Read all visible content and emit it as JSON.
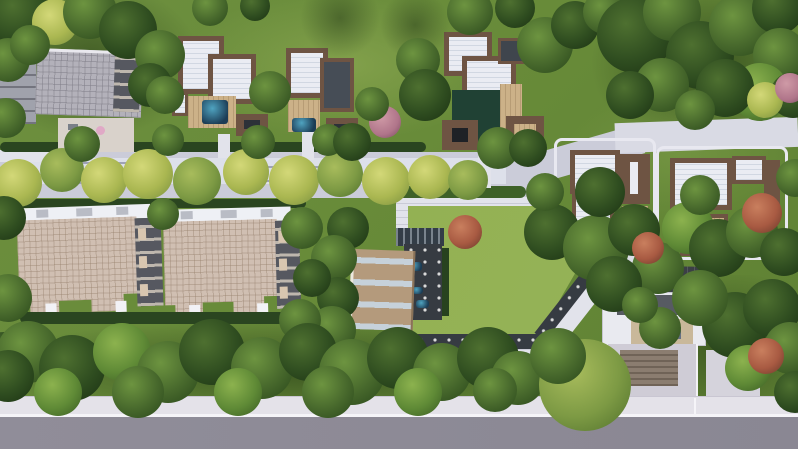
{
  "scene": {
    "description": "Aerial top-down 3D architectural rendering of a gated residential development: flat-roofed villas with brown trim in the upper and right areas, two large apartment blocks with beige panel roofs at lower left, a central lawn bordered by stepped white paths and dark bollard-lit paving, a pool clubhouse with skylight roof, tree-lined internal walkways, an entrance gatehouse at lower right, dense perimeter trees and a grey asphalt road along the bottom edge",
    "features": {
      "villas_top_row": 3,
      "villas_right_side": 2,
      "apartment_blocks": 2,
      "clubhouse_with_pool_deck": 1,
      "entrance_gatehouse": 1,
      "central_lawn": 1,
      "tree_lined_walkways": 2,
      "perimeter_road_bottom": 1
    },
    "palette": {
      "grass_base": "#6d8f3f",
      "grass_light": "#93b153",
      "grass_dark": "#4e6e2f",
      "lawn": "#95b257",
      "walk": "#cbccd9",
      "walk_light": "#e2e3eb",
      "road_asphalt": "#8a8793",
      "sidewalk": "#e4e2e9",
      "white_line": "#f5f4f8",
      "roof_white": "#eaecf3",
      "roof_trim": "#6e5443",
      "roof_grey": "#b3b1ba",
      "facade_dark": "#565860",
      "apt_roof": "#d0bfb2",
      "deck_tan": "#ccb188",
      "pool_blue": "#1c3c55",
      "pool_cyan": "#4fa3c0",
      "dark_paving": "#363b42",
      "hedge": "#2a4520",
      "club_roof": "#b49a7c",
      "glass": "#c2cfdb",
      "tree_dark": "#2f4d20",
      "tree_mid": "#47682c",
      "tree_bright": "#5f8a36",
      "tree_yellow": "#aab751",
      "tree_olive": "#7d9a44",
      "tree_red": "#a85a42",
      "tree_pink": "#b0758a"
    },
    "trees": [
      {
        "x": 20,
        "y": 15,
        "d": 64,
        "t": "dark"
      },
      {
        "x": 55,
        "y": 22,
        "d": 46,
        "t": "yellow"
      },
      {
        "x": 90,
        "y": 12,
        "d": 54,
        "t": "mid"
      },
      {
        "x": 128,
        "y": 30,
        "d": 58,
        "t": "dark"
      },
      {
        "x": 160,
        "y": 55,
        "d": 50,
        "t": "mid"
      },
      {
        "x": 8,
        "y": 60,
        "d": 44,
        "t": "mid"
      },
      {
        "x": 30,
        "y": 45,
        "d": 40,
        "t": "mid"
      },
      {
        "x": 150,
        "y": 85,
        "d": 44,
        "t": "dark"
      },
      {
        "x": 210,
        "y": 8,
        "d": 36,
        "t": "mid"
      },
      {
        "x": 255,
        "y": 6,
        "d": 30,
        "t": "dark"
      },
      {
        "x": 340,
        "y": 18,
        "d": 80,
        "t": "shadow"
      },
      {
        "x": 415,
        "y": 25,
        "d": 70,
        "t": "shadow"
      },
      {
        "x": 418,
        "y": 60,
        "d": 44,
        "t": "mid"
      },
      {
        "x": 425,
        "y": 95,
        "d": 52,
        "t": "dark"
      },
      {
        "x": 470,
        "y": 12,
        "d": 46,
        "t": "mid"
      },
      {
        "x": 515,
        "y": 8,
        "d": 40,
        "t": "dark"
      },
      {
        "x": 545,
        "y": 45,
        "d": 56,
        "t": "mid"
      },
      {
        "x": 575,
        "y": 25,
        "d": 48,
        "t": "dark"
      },
      {
        "x": 605,
        "y": 12,
        "d": 44,
        "t": "mid"
      },
      {
        "x": 635,
        "y": 35,
        "d": 76,
        "t": "dark"
      },
      {
        "x": 672,
        "y": 12,
        "d": 58,
        "t": "mid"
      },
      {
        "x": 700,
        "y": 55,
        "d": 68,
        "t": "dark"
      },
      {
        "x": 740,
        "y": 25,
        "d": 62,
        "t": "mid"
      },
      {
        "x": 778,
        "y": 8,
        "d": 52,
        "t": "dark"
      },
      {
        "x": 780,
        "y": 55,
        "d": 54,
        "t": "mid"
      },
      {
        "x": 760,
        "y": 92,
        "d": 58,
        "t": "bright"
      },
      {
        "x": 793,
        "y": 95,
        "d": 46,
        "t": "dark"
      },
      {
        "x": 725,
        "y": 88,
        "d": 58,
        "t": "dark"
      },
      {
        "x": 662,
        "y": 85,
        "d": 54,
        "t": "mid"
      },
      {
        "x": 630,
        "y": 95,
        "d": 48,
        "t": "dark"
      },
      {
        "x": 695,
        "y": 110,
        "d": 40,
        "t": "mid"
      },
      {
        "x": 765,
        "y": 100,
        "d": 36,
        "t": "yellow"
      },
      {
        "x": 790,
        "y": 88,
        "d": 30,
        "t": "pink"
      },
      {
        "x": 18,
        "y": 183,
        "d": 48,
        "t": "yellow"
      },
      {
        "x": 62,
        "y": 170,
        "d": 44,
        "t": "olive"
      },
      {
        "x": 104,
        "y": 180,
        "d": 46,
        "t": "yellow"
      },
      {
        "x": 148,
        "y": 174,
        "d": 50,
        "t": "yellow"
      },
      {
        "x": 197,
        "y": 181,
        "d": 48,
        "t": "olive"
      },
      {
        "x": 246,
        "y": 172,
        "d": 46,
        "t": "yellow"
      },
      {
        "x": 294,
        "y": 180,
        "d": 50,
        "t": "yellow"
      },
      {
        "x": 340,
        "y": 174,
        "d": 46,
        "t": "olive"
      },
      {
        "x": 386,
        "y": 181,
        "d": 48,
        "t": "yellow"
      },
      {
        "x": 430,
        "y": 177,
        "d": 44,
        "t": "yellow"
      },
      {
        "x": 468,
        "y": 180,
        "d": 40,
        "t": "olive"
      },
      {
        "x": 82,
        "y": 144,
        "d": 36,
        "t": "mid"
      },
      {
        "x": 168,
        "y": 140,
        "d": 32,
        "t": "mid"
      },
      {
        "x": 258,
        "y": 142,
        "d": 34,
        "t": "mid"
      },
      {
        "x": 328,
        "y": 140,
        "d": 32,
        "t": "mid"
      },
      {
        "x": 6,
        "y": 118,
        "d": 40,
        "t": "mid"
      },
      {
        "x": 4,
        "y": 218,
        "d": 44,
        "t": "dark"
      },
      {
        "x": 8,
        "y": 298,
        "d": 48,
        "t": "mid"
      },
      {
        "x": 4,
        "y": 358,
        "d": 52,
        "t": "dark"
      },
      {
        "x": 270,
        "y": 92,
        "d": 42,
        "t": "mid"
      },
      {
        "x": 165,
        "y": 95,
        "d": 38,
        "t": "mid"
      },
      {
        "x": 385,
        "y": 122,
        "d": 32,
        "t": "pink"
      },
      {
        "x": 352,
        "y": 142,
        "d": 38,
        "t": "dark"
      },
      {
        "x": 372,
        "y": 104,
        "d": 34,
        "t": "mid"
      },
      {
        "x": 498,
        "y": 148,
        "d": 42,
        "t": "mid"
      },
      {
        "x": 528,
        "y": 148,
        "d": 38,
        "t": "dark"
      },
      {
        "x": 552,
        "y": 232,
        "d": 56,
        "t": "dark"
      },
      {
        "x": 596,
        "y": 248,
        "d": 66,
        "t": "mid"
      },
      {
        "x": 634,
        "y": 230,
        "d": 52,
        "t": "dark"
      },
      {
        "x": 658,
        "y": 268,
        "d": 52,
        "t": "mid"
      },
      {
        "x": 614,
        "y": 284,
        "d": 56,
        "t": "dark"
      },
      {
        "x": 648,
        "y": 248,
        "d": 32,
        "t": "red"
      },
      {
        "x": 545,
        "y": 192,
        "d": 38,
        "t": "mid"
      },
      {
        "x": 600,
        "y": 192,
        "d": 50,
        "t": "dark"
      },
      {
        "x": 688,
        "y": 228,
        "d": 52,
        "t": "bright"
      },
      {
        "x": 718,
        "y": 248,
        "d": 58,
        "t": "dark"
      },
      {
        "x": 752,
        "y": 232,
        "d": 52,
        "t": "mid"
      },
      {
        "x": 784,
        "y": 252,
        "d": 48,
        "t": "dark"
      },
      {
        "x": 762,
        "y": 213,
        "d": 40,
        "t": "red"
      },
      {
        "x": 795,
        "y": 178,
        "d": 38,
        "t": "mid"
      },
      {
        "x": 700,
        "y": 195,
        "d": 40,
        "t": "mid"
      },
      {
        "x": 348,
        "y": 228,
        "d": 42,
        "t": "dark"
      },
      {
        "x": 334,
        "y": 258,
        "d": 46,
        "t": "mid"
      },
      {
        "x": 338,
        "y": 298,
        "d": 42,
        "t": "dark"
      },
      {
        "x": 332,
        "y": 330,
        "d": 48,
        "t": "mid"
      },
      {
        "x": 465,
        "y": 232,
        "d": 34,
        "t": "red"
      },
      {
        "x": 163,
        "y": 214,
        "d": 32,
        "t": "mid"
      },
      {
        "x": 302,
        "y": 228,
        "d": 42,
        "t": "mid"
      },
      {
        "x": 312,
        "y": 278,
        "d": 38,
        "t": "dark"
      },
      {
        "x": 300,
        "y": 320,
        "d": 42,
        "t": "mid"
      },
      {
        "x": 28,
        "y": 352,
        "d": 62,
        "t": "mid"
      },
      {
        "x": 72,
        "y": 368,
        "d": 66,
        "t": "dark"
      },
      {
        "x": 122,
        "y": 352,
        "d": 58,
        "t": "bright"
      },
      {
        "x": 168,
        "y": 372,
        "d": 62,
        "t": "mid"
      },
      {
        "x": 212,
        "y": 352,
        "d": 66,
        "t": "dark"
      },
      {
        "x": 262,
        "y": 368,
        "d": 62,
        "t": "mid"
      },
      {
        "x": 308,
        "y": 352,
        "d": 58,
        "t": "dark"
      },
      {
        "x": 352,
        "y": 372,
        "d": 66,
        "t": "mid"
      },
      {
        "x": 398,
        "y": 358,
        "d": 62,
        "t": "dark"
      },
      {
        "x": 442,
        "y": 372,
        "d": 58,
        "t": "mid"
      },
      {
        "x": 488,
        "y": 358,
        "d": 62,
        "t": "dark"
      },
      {
        "x": 518,
        "y": 378,
        "d": 54,
        "t": "mid"
      },
      {
        "x": 58,
        "y": 392,
        "d": 48,
        "t": "bright"
      },
      {
        "x": 138,
        "y": 392,
        "d": 52,
        "t": "mid"
      },
      {
        "x": 238,
        "y": 392,
        "d": 48,
        "t": "bright"
      },
      {
        "x": 328,
        "y": 392,
        "d": 52,
        "t": "mid"
      },
      {
        "x": 418,
        "y": 392,
        "d": 48,
        "t": "bright"
      },
      {
        "x": 8,
        "y": 376,
        "d": 52,
        "t": "dark"
      },
      {
        "x": 495,
        "y": 390,
        "d": 44,
        "t": "mid"
      },
      {
        "x": 585,
        "y": 385,
        "d": 92,
        "t": "olive"
      },
      {
        "x": 558,
        "y": 356,
        "d": 56,
        "t": "mid"
      },
      {
        "x": 735,
        "y": 325,
        "d": 66,
        "t": "dark"
      },
      {
        "x": 700,
        "y": 298,
        "d": 56,
        "t": "mid"
      },
      {
        "x": 772,
        "y": 308,
        "d": 58,
        "t": "dark"
      },
      {
        "x": 790,
        "y": 348,
        "d": 52,
        "t": "mid"
      },
      {
        "x": 748,
        "y": 368,
        "d": 46,
        "t": "bright"
      },
      {
        "x": 766,
        "y": 356,
        "d": 36,
        "t": "red"
      },
      {
        "x": 795,
        "y": 392,
        "d": 42,
        "t": "dark"
      },
      {
        "x": 660,
        "y": 328,
        "d": 42,
        "t": "mid"
      },
      {
        "x": 640,
        "y": 305,
        "d": 36,
        "t": "mid"
      }
    ]
  }
}
